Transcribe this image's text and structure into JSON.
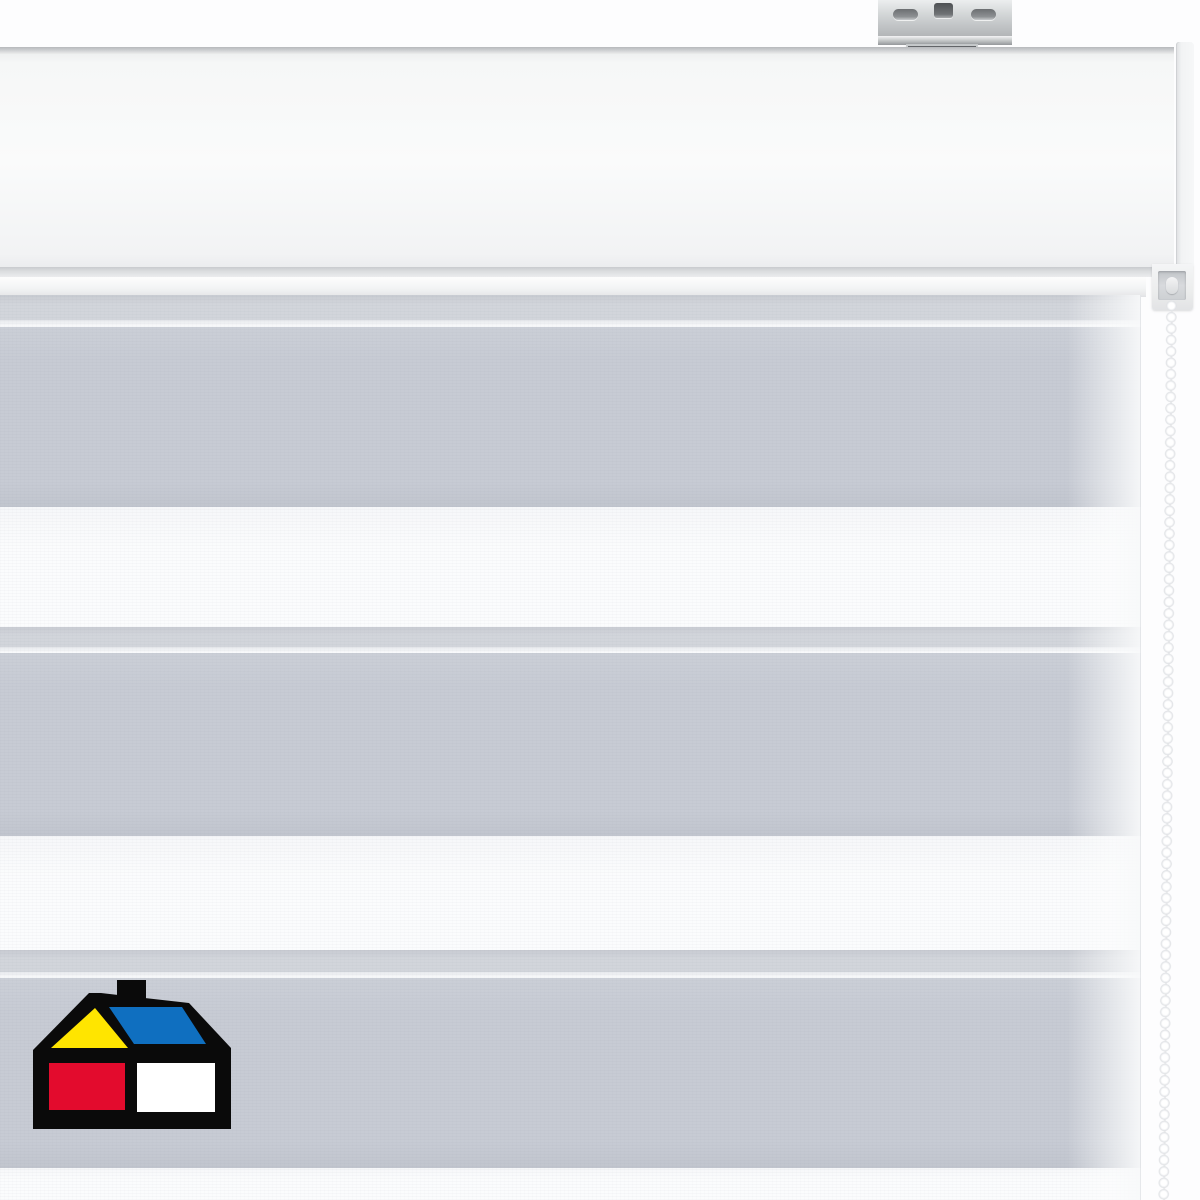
{
  "meta": {
    "description": "Product photo of a white/gray day-night zebra roller blind: white cassette head rail with galvanized metal ceiling bracket, striped translucent fabric (gray and sheer white horizontal bands), white bead control chain on the right, and a house-shaped hardware-store logo at the lower left.",
    "text_on_screen": ""
  },
  "colors": {
    "background": "#fdfdfe",
    "fabric-gray": "#c7cbd4",
    "fabric-gray-hi": "#cbcfd7",
    "fabric-gray-lo": "#c1c5ce",
    "fabric-edge": "#d2d5db",
    "fabric-edge-dark": "#c8cbd2",
    "fabric-line": "#e7e9ed",
    "fabric-white": "#fbfcfd",
    "fabric-white-hi": "#f6f7f9",
    "bead-shade": "#dfe1e4",
    "logo-black": "#0a0a0a",
    "logo-yellow": "#ffe500",
    "logo-blue": "#0f6fc0",
    "logo-red": "#e30b2d",
    "logo-white": "#ffffff"
  },
  "fabric": {
    "stripe_pattern": "alternating gray translucent and white sheer horizontal bands",
    "gray_band_count": 3,
    "white_band_count": 3,
    "bands": [
      {
        "type": "gray-edge",
        "top": 0,
        "height": 25
      },
      {
        "type": "highlight",
        "top": 25,
        "height": 7
      },
      {
        "type": "gray",
        "top": 32,
        "height": 180
      },
      {
        "type": "white",
        "top": 212,
        "height": 120
      },
      {
        "type": "gray-edge",
        "top": 332,
        "height": 20
      },
      {
        "type": "highlight",
        "top": 352,
        "height": 6
      },
      {
        "type": "gray",
        "top": 358,
        "height": 183
      },
      {
        "type": "white",
        "top": 541,
        "height": 114
      },
      {
        "type": "gray-edge",
        "top": 655,
        "height": 22
      },
      {
        "type": "highlight",
        "top": 677,
        "height": 6
      },
      {
        "type": "gray",
        "top": 683,
        "height": 190
      },
      {
        "type": "white",
        "top": 873,
        "height": 32
      }
    ]
  },
  "chain": {
    "bead_pitch_px": 11.4,
    "bead_color": "white"
  },
  "logo": {
    "shape": "house with chimney, yellow gable triangle, blue roof, red and white squares"
  }
}
